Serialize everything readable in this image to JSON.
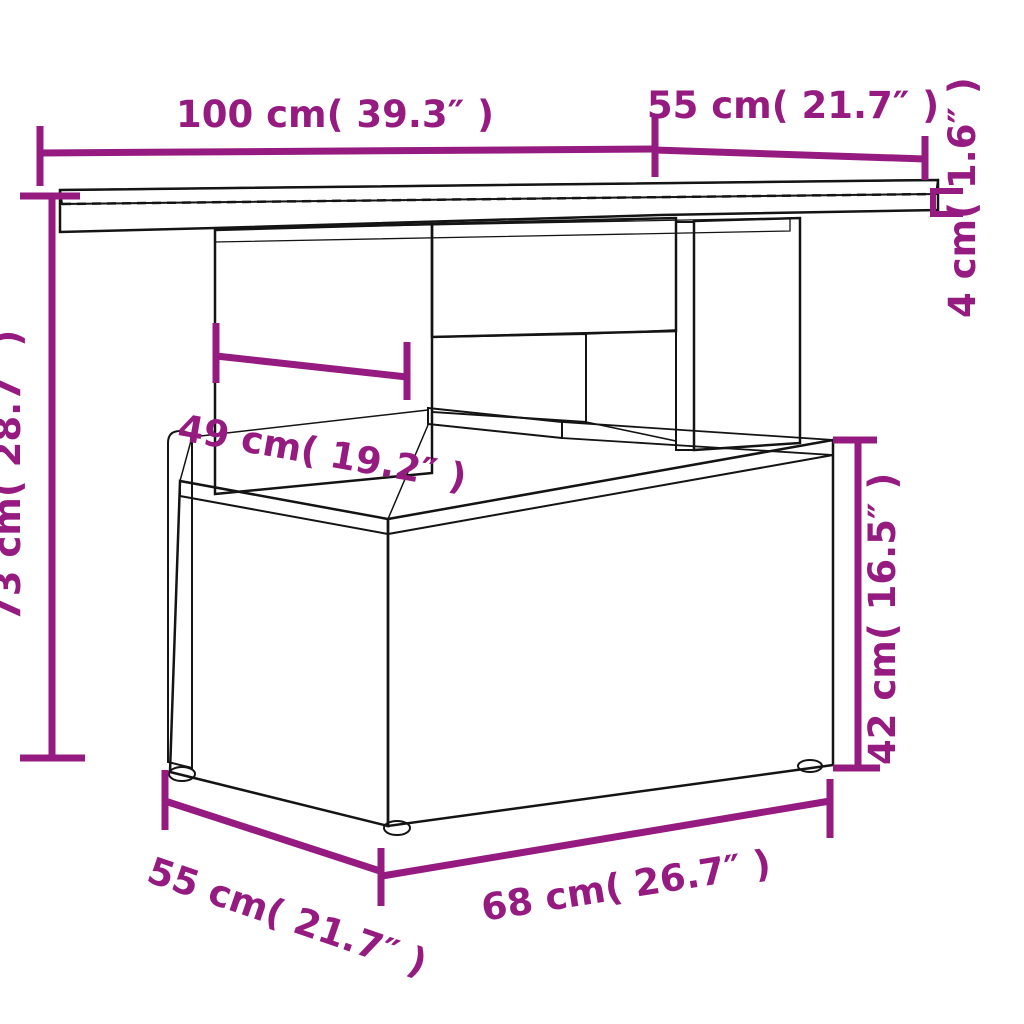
{
  "diagram": {
    "title": "Poly rattan garden table dimension diagram",
    "accent_color": "#951b81",
    "line_color": "#141414",
    "glass_color": "#8e8e8e",
    "background_color": "#ffffff",
    "dimensions": {
      "table_width": {
        "label": "100 cm( 39.3″ )"
      },
      "table_depth": {
        "label": "55 cm( 21.7″ )"
      },
      "tabletop_thickness": {
        "label": "4 cm( 1.6″ )"
      },
      "table_height": {
        "label": "73 cm( 28.7″ )"
      },
      "opening_width": {
        "label": "49 cm( 19.2″ )"
      },
      "base_height": {
        "label": "42 cm( 16.5″ )"
      },
      "base_depth": {
        "label": "55 cm( 21.7″ )"
      },
      "base_width": {
        "label": "68 cm( 26.7″ )"
      }
    }
  }
}
